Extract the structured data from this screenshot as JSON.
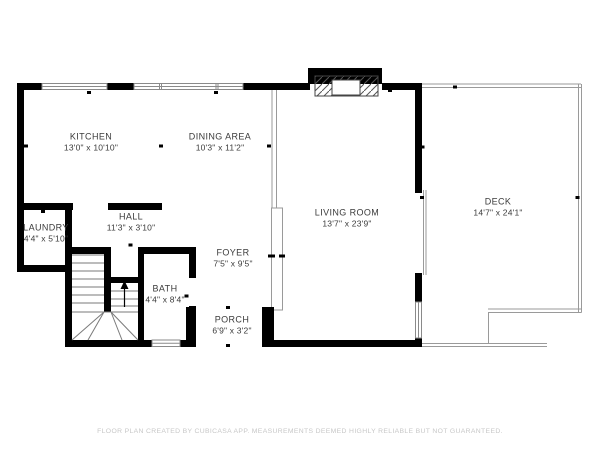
{
  "floor_plan": {
    "rooms": [
      {
        "name": "KITCHEN",
        "dimensions": "13'0\" x 10'10\""
      },
      {
        "name": "DINING AREA",
        "dimensions": "10'3\" x 11'2\""
      },
      {
        "name": "LIVING ROOM",
        "dimensions": "13'7\" x 23'9\""
      },
      {
        "name": "DECK",
        "dimensions": "14'7\" x 24'1\""
      },
      {
        "name": "LAUNDRY",
        "dimensions": "4'4\" x 5'10\""
      },
      {
        "name": "HALL",
        "dimensions": "11'3\" x 3'10\""
      },
      {
        "name": "FOYER",
        "dimensions": "7'5\" x 9'5\""
      },
      {
        "name": "BATH",
        "dimensions": "4'4\" x 8'4\""
      },
      {
        "name": "PORCH",
        "dimensions": "6'9\" x 3'2\""
      }
    ],
    "footer": "FLOOR PLAN CREATED BY CUBICASA APP. MEASUREMENTS DEEMED HIGHLY RELIABLE BUT NOT GUARANTEED.",
    "colors": {
      "wall": "#000000",
      "thin_line": "#999999",
      "label": "#3b3b3b",
      "footer_text": "#c7c7c7",
      "background": "#ffffff"
    }
  }
}
